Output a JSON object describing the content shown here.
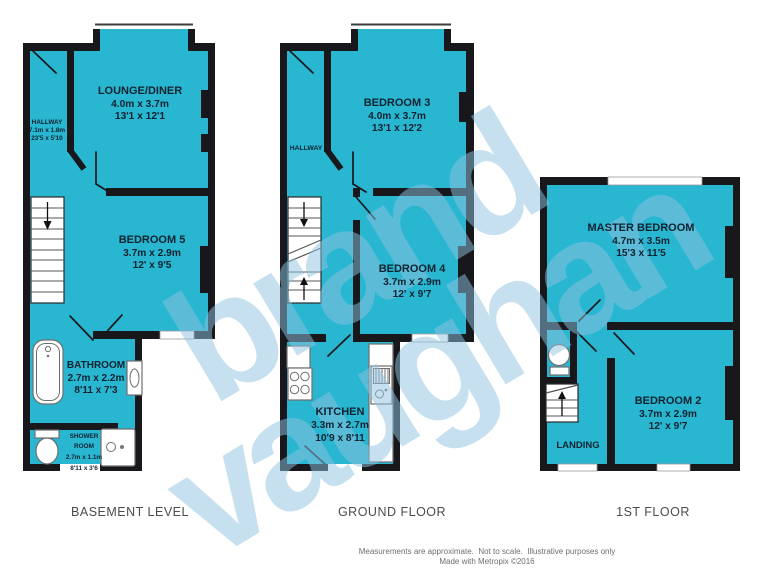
{
  "watermark": {
    "word1": "brand",
    "word2": "vaughan"
  },
  "basement": {
    "floor_label": "BASEMENT LEVEL",
    "hallway": {
      "name": "HALLWAY",
      "metric": "7.1m x 1.8m",
      "imperial": "23'5 x 5'10"
    },
    "lounge": {
      "name": "LOUNGE/DINER",
      "metric": "4.0m x 3.7m",
      "imperial": "13'1 x 12'1"
    },
    "bedroom5": {
      "name": "BEDROOM 5",
      "metric": "3.7m x 2.9m",
      "imperial": "12' x 9'5"
    },
    "bathroom": {
      "name": "BATHROOM",
      "metric": "2.7m x 2.2m",
      "imperial": "8'11 x 7'3"
    },
    "shower_room": {
      "name_line1": "SHOWER",
      "name_line2": "ROOM",
      "metric": "2.7m x 1.1m",
      "imperial": "8'11 x 3'6"
    }
  },
  "ground": {
    "floor_label": "GROUND FLOOR",
    "hallway": {
      "name": "HALLWAY"
    },
    "bedroom3": {
      "name": "BEDROOM 3",
      "metric": "4.0m x 3.7m",
      "imperial": "13'1 x 12'2"
    },
    "bedroom4": {
      "name": "BEDROOM 4",
      "metric": "3.7m x 2.9m",
      "imperial": "12' x 9'7"
    },
    "kitchen": {
      "name": "KITCHEN",
      "metric": "3.3m x 2.7m",
      "imperial": "10'9 x 8'11"
    }
  },
  "first": {
    "floor_label": "1ST FLOOR",
    "master": {
      "name": "MASTER BEDROOM",
      "metric": "4.7m x 3.5m",
      "imperial": "15'3 x 11'5"
    },
    "bedroom2": {
      "name": "BEDROOM 2",
      "metric": "3.7m x 2.9m",
      "imperial": "12' x 9'7"
    },
    "landing": {
      "name": "LANDING"
    }
  },
  "footer": {
    "disclaimer": "Measurements are approximate.  Not to scale.  Illustrative purposes only",
    "credit": "Made with Metropix ©2016"
  },
  "colors": {
    "room_fill": "#29b6d1",
    "wall": "#18181c",
    "watermark": "#8fc3e0"
  }
}
